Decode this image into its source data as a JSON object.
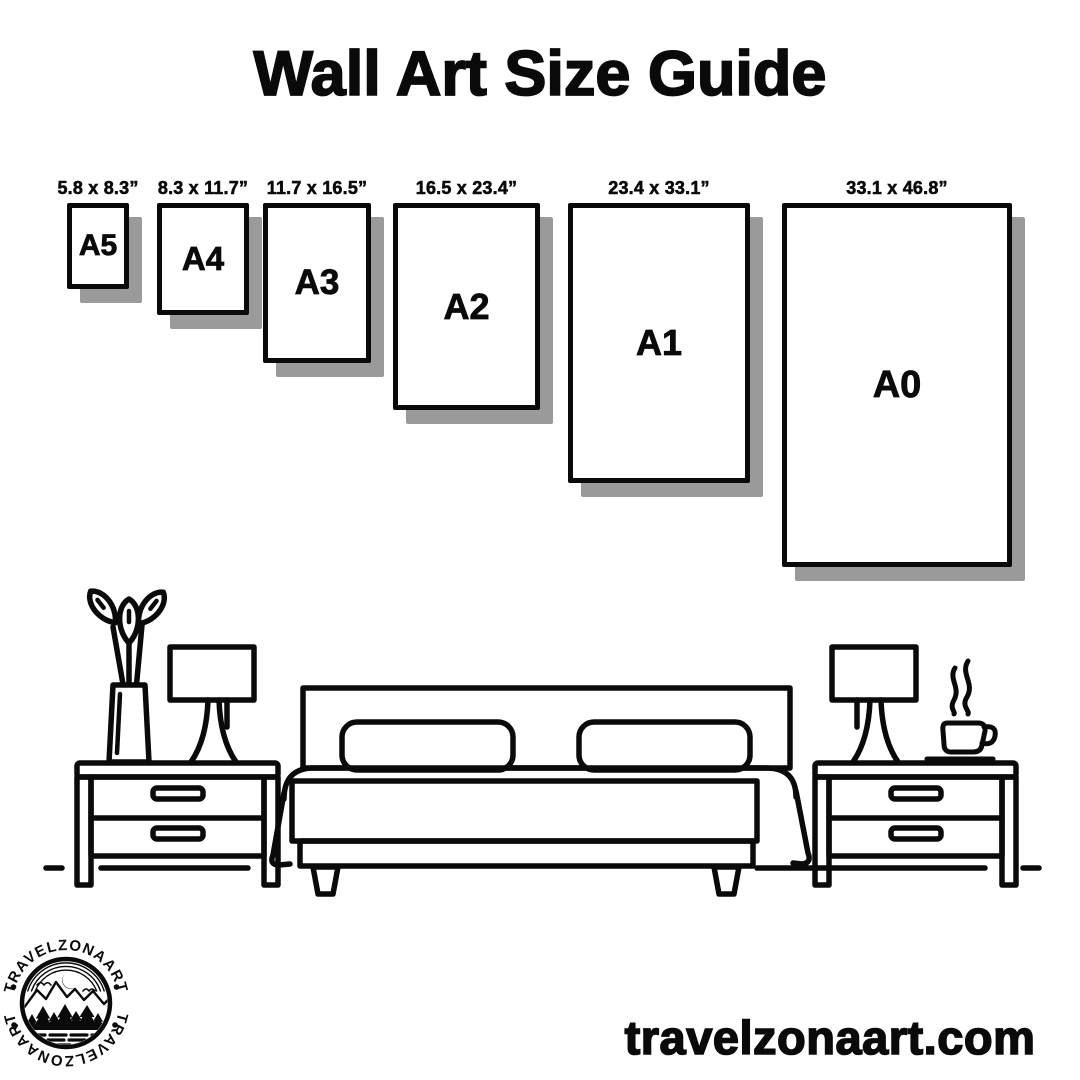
{
  "title": "Wall Art Size Guide",
  "frames": [
    {
      "name": "A5",
      "dimensions": "5.8 x 8.3”"
    },
    {
      "name": "A4",
      "dimensions": "8.3 x 11.7”"
    },
    {
      "name": "A3",
      "dimensions": "11.7 x 16.5”"
    },
    {
      "name": "A2",
      "dimensions": "16.5 x 23.4”"
    },
    {
      "name": "A1",
      "dimensions": "23.4 x 33.1”"
    },
    {
      "name": "A0",
      "dimensions": "33.1 x 46.8”"
    }
  ],
  "logo": {
    "arc_text_top": "TRAVELZONAART",
    "arc_text_bottom": "TRAVELZONAART"
  },
  "footer": {
    "website": "travelzonaart.com"
  },
  "colors": {
    "ink": "#0a0a0a",
    "frame_shadow": "#9a9a9a",
    "background": "#ffffff"
  }
}
